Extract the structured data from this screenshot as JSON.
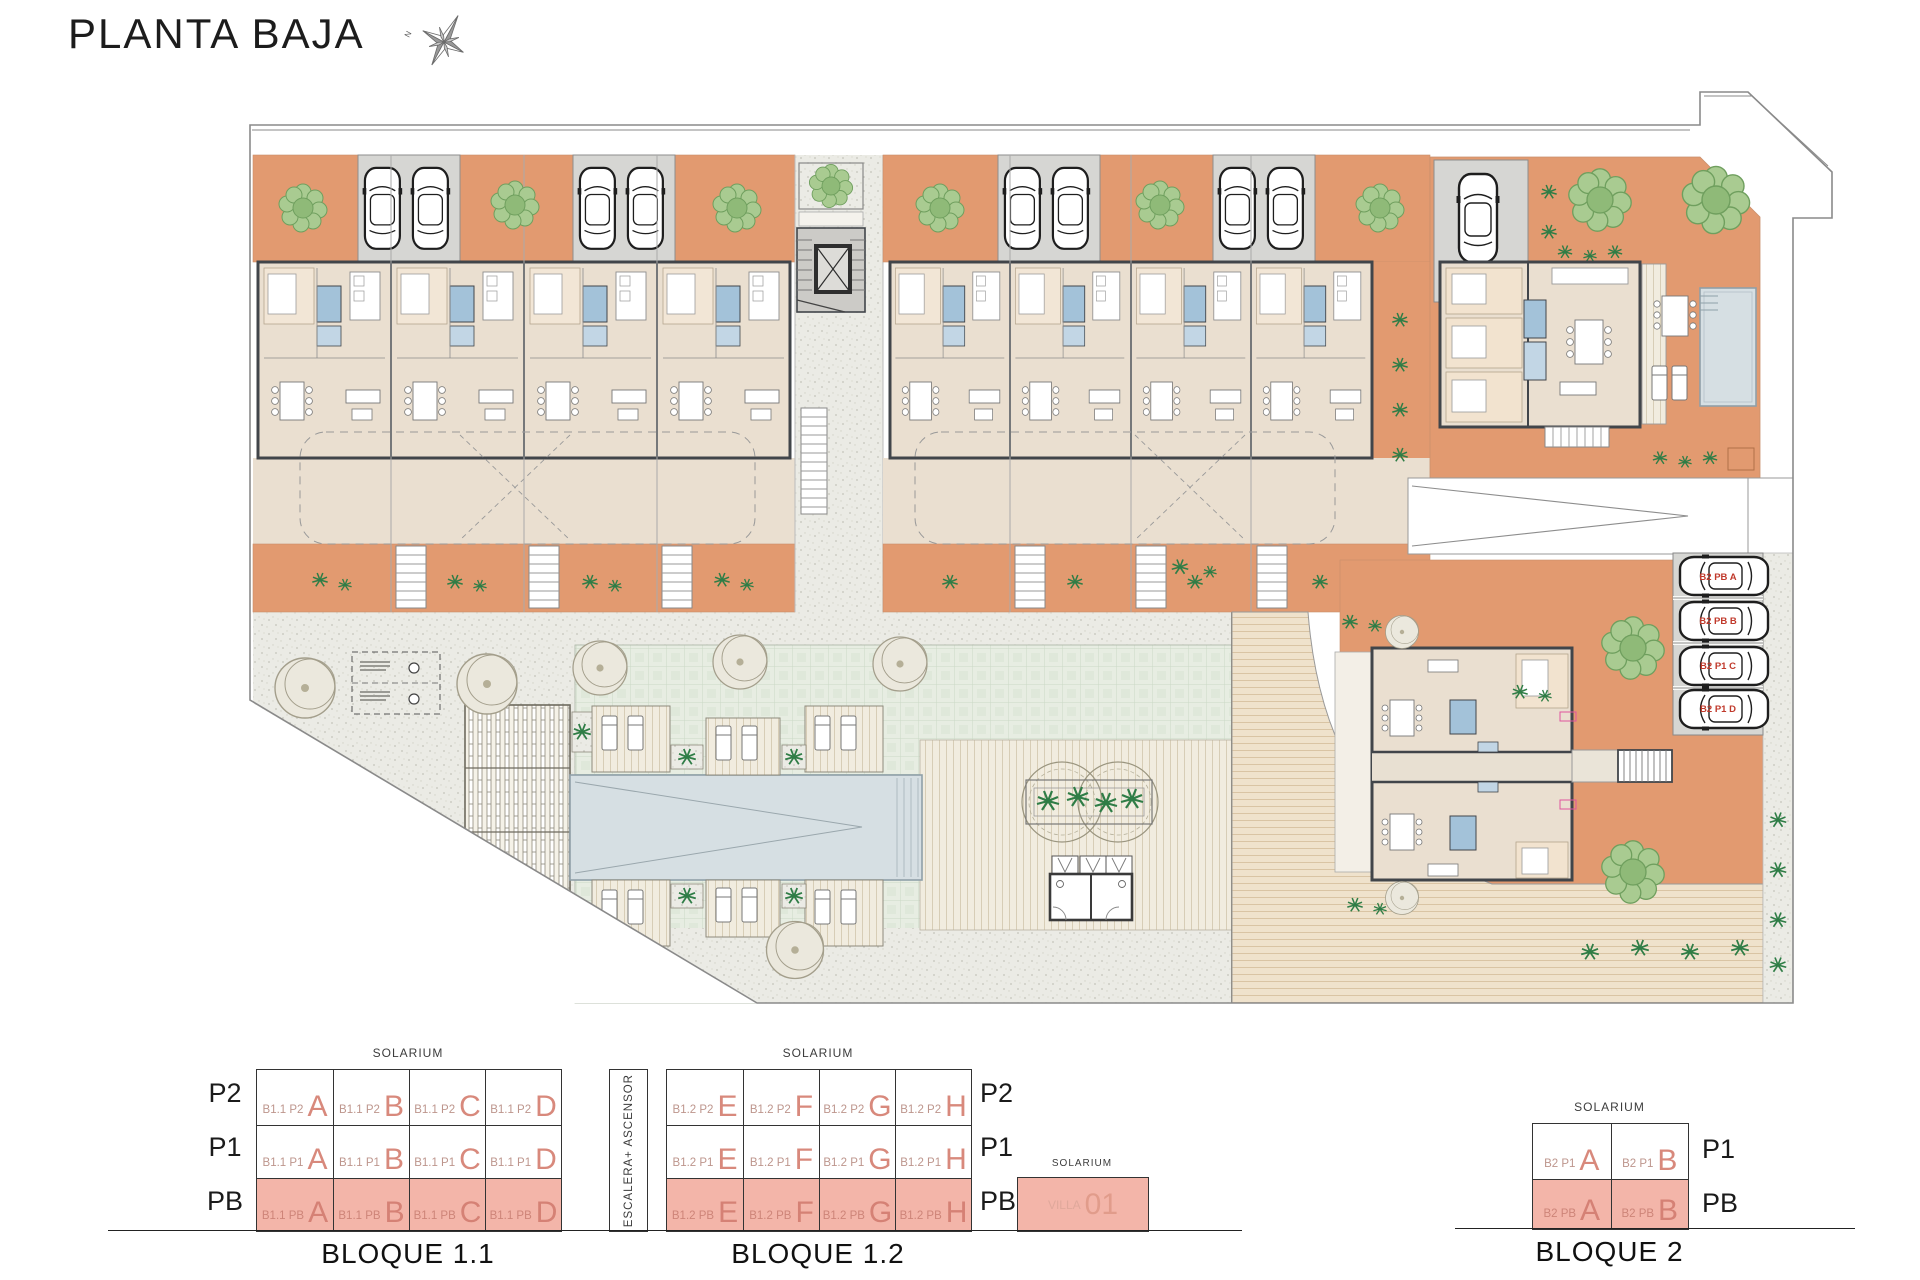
{
  "title": "PLANTA BAJA",
  "compass": {
    "north": "N"
  },
  "colors": {
    "terrace_orange": "#E29A70",
    "legend_salmon": "#F3B5A9",
    "unit_letter_red": "#D8897C",
    "parking_label_red": "#C0392B",
    "pool_blue": "#D6DFE3",
    "lawn_green": "#E7EDE2",
    "floor_beige": "#EADFD0",
    "wall_dark": "#41454A",
    "bath_blue": "#A3C2D9",
    "paving_gray": "#D6D6D3"
  },
  "plan": {
    "parking_labels": [
      "B2 PB A",
      "B2 PB B",
      "B2 P1 C",
      "B2 P1 D"
    ]
  },
  "legend": {
    "solarium": "SOLARIUM",
    "escalera": "ESCALERA+ ASCENSOR",
    "b11": {
      "name": "BLOQUE 1.1",
      "floors": [
        "P2",
        "P1",
        "PB"
      ],
      "cells": [
        [
          {
            "prefix": "B1.1 P2",
            "letter": "A"
          },
          {
            "prefix": "B1.1 P2",
            "letter": "B"
          },
          {
            "prefix": "B1.1 P2",
            "letter": "C"
          },
          {
            "prefix": "B1.1 P2",
            "letter": "D"
          }
        ],
        [
          {
            "prefix": "B1.1 P1",
            "letter": "A"
          },
          {
            "prefix": "B1.1 P1",
            "letter": "B"
          },
          {
            "prefix": "B1.1 P1",
            "letter": "C"
          },
          {
            "prefix": "B1.1 P1",
            "letter": "D"
          }
        ],
        [
          {
            "prefix": "B1.1 PB",
            "letter": "A"
          },
          {
            "prefix": "B1.1 PB",
            "letter": "B"
          },
          {
            "prefix": "B1.1 PB",
            "letter": "C"
          },
          {
            "prefix": "B1.1 PB",
            "letter": "D"
          }
        ]
      ]
    },
    "b12": {
      "name": "BLOQUE 1.2",
      "floors": [
        "P2",
        "P1",
        "PB"
      ],
      "cells": [
        [
          {
            "prefix": "B1.2 P2",
            "letter": "E"
          },
          {
            "prefix": "B1.2 P2",
            "letter": "F"
          },
          {
            "prefix": "B1.2 P2",
            "letter": "G"
          },
          {
            "prefix": "B1.2 P2",
            "letter": "H"
          }
        ],
        [
          {
            "prefix": "B1.2 P1",
            "letter": "E"
          },
          {
            "prefix": "B1.2 P1",
            "letter": "F"
          },
          {
            "prefix": "B1.2 P1",
            "letter": "G"
          },
          {
            "prefix": "B1.2 P1",
            "letter": "H"
          }
        ],
        [
          {
            "prefix": "B1.2 PB",
            "letter": "E"
          },
          {
            "prefix": "B1.2 PB",
            "letter": "F"
          },
          {
            "prefix": "B1.2 PB",
            "letter": "G"
          },
          {
            "prefix": "B1.2 PB",
            "letter": "H"
          }
        ]
      ]
    },
    "villa": {
      "prefix": "VILLA",
      "number": "01"
    },
    "b2": {
      "name": "BLOQUE 2",
      "floors": [
        "P1",
        "PB"
      ],
      "cells": [
        [
          {
            "prefix": "B2 P1",
            "letter": "A"
          },
          {
            "prefix": "B2 P1",
            "letter": "B"
          }
        ],
        [
          {
            "prefix": "B2 PB",
            "letter": "A"
          },
          {
            "prefix": "B2 PB",
            "letter": "B"
          }
        ]
      ]
    }
  }
}
